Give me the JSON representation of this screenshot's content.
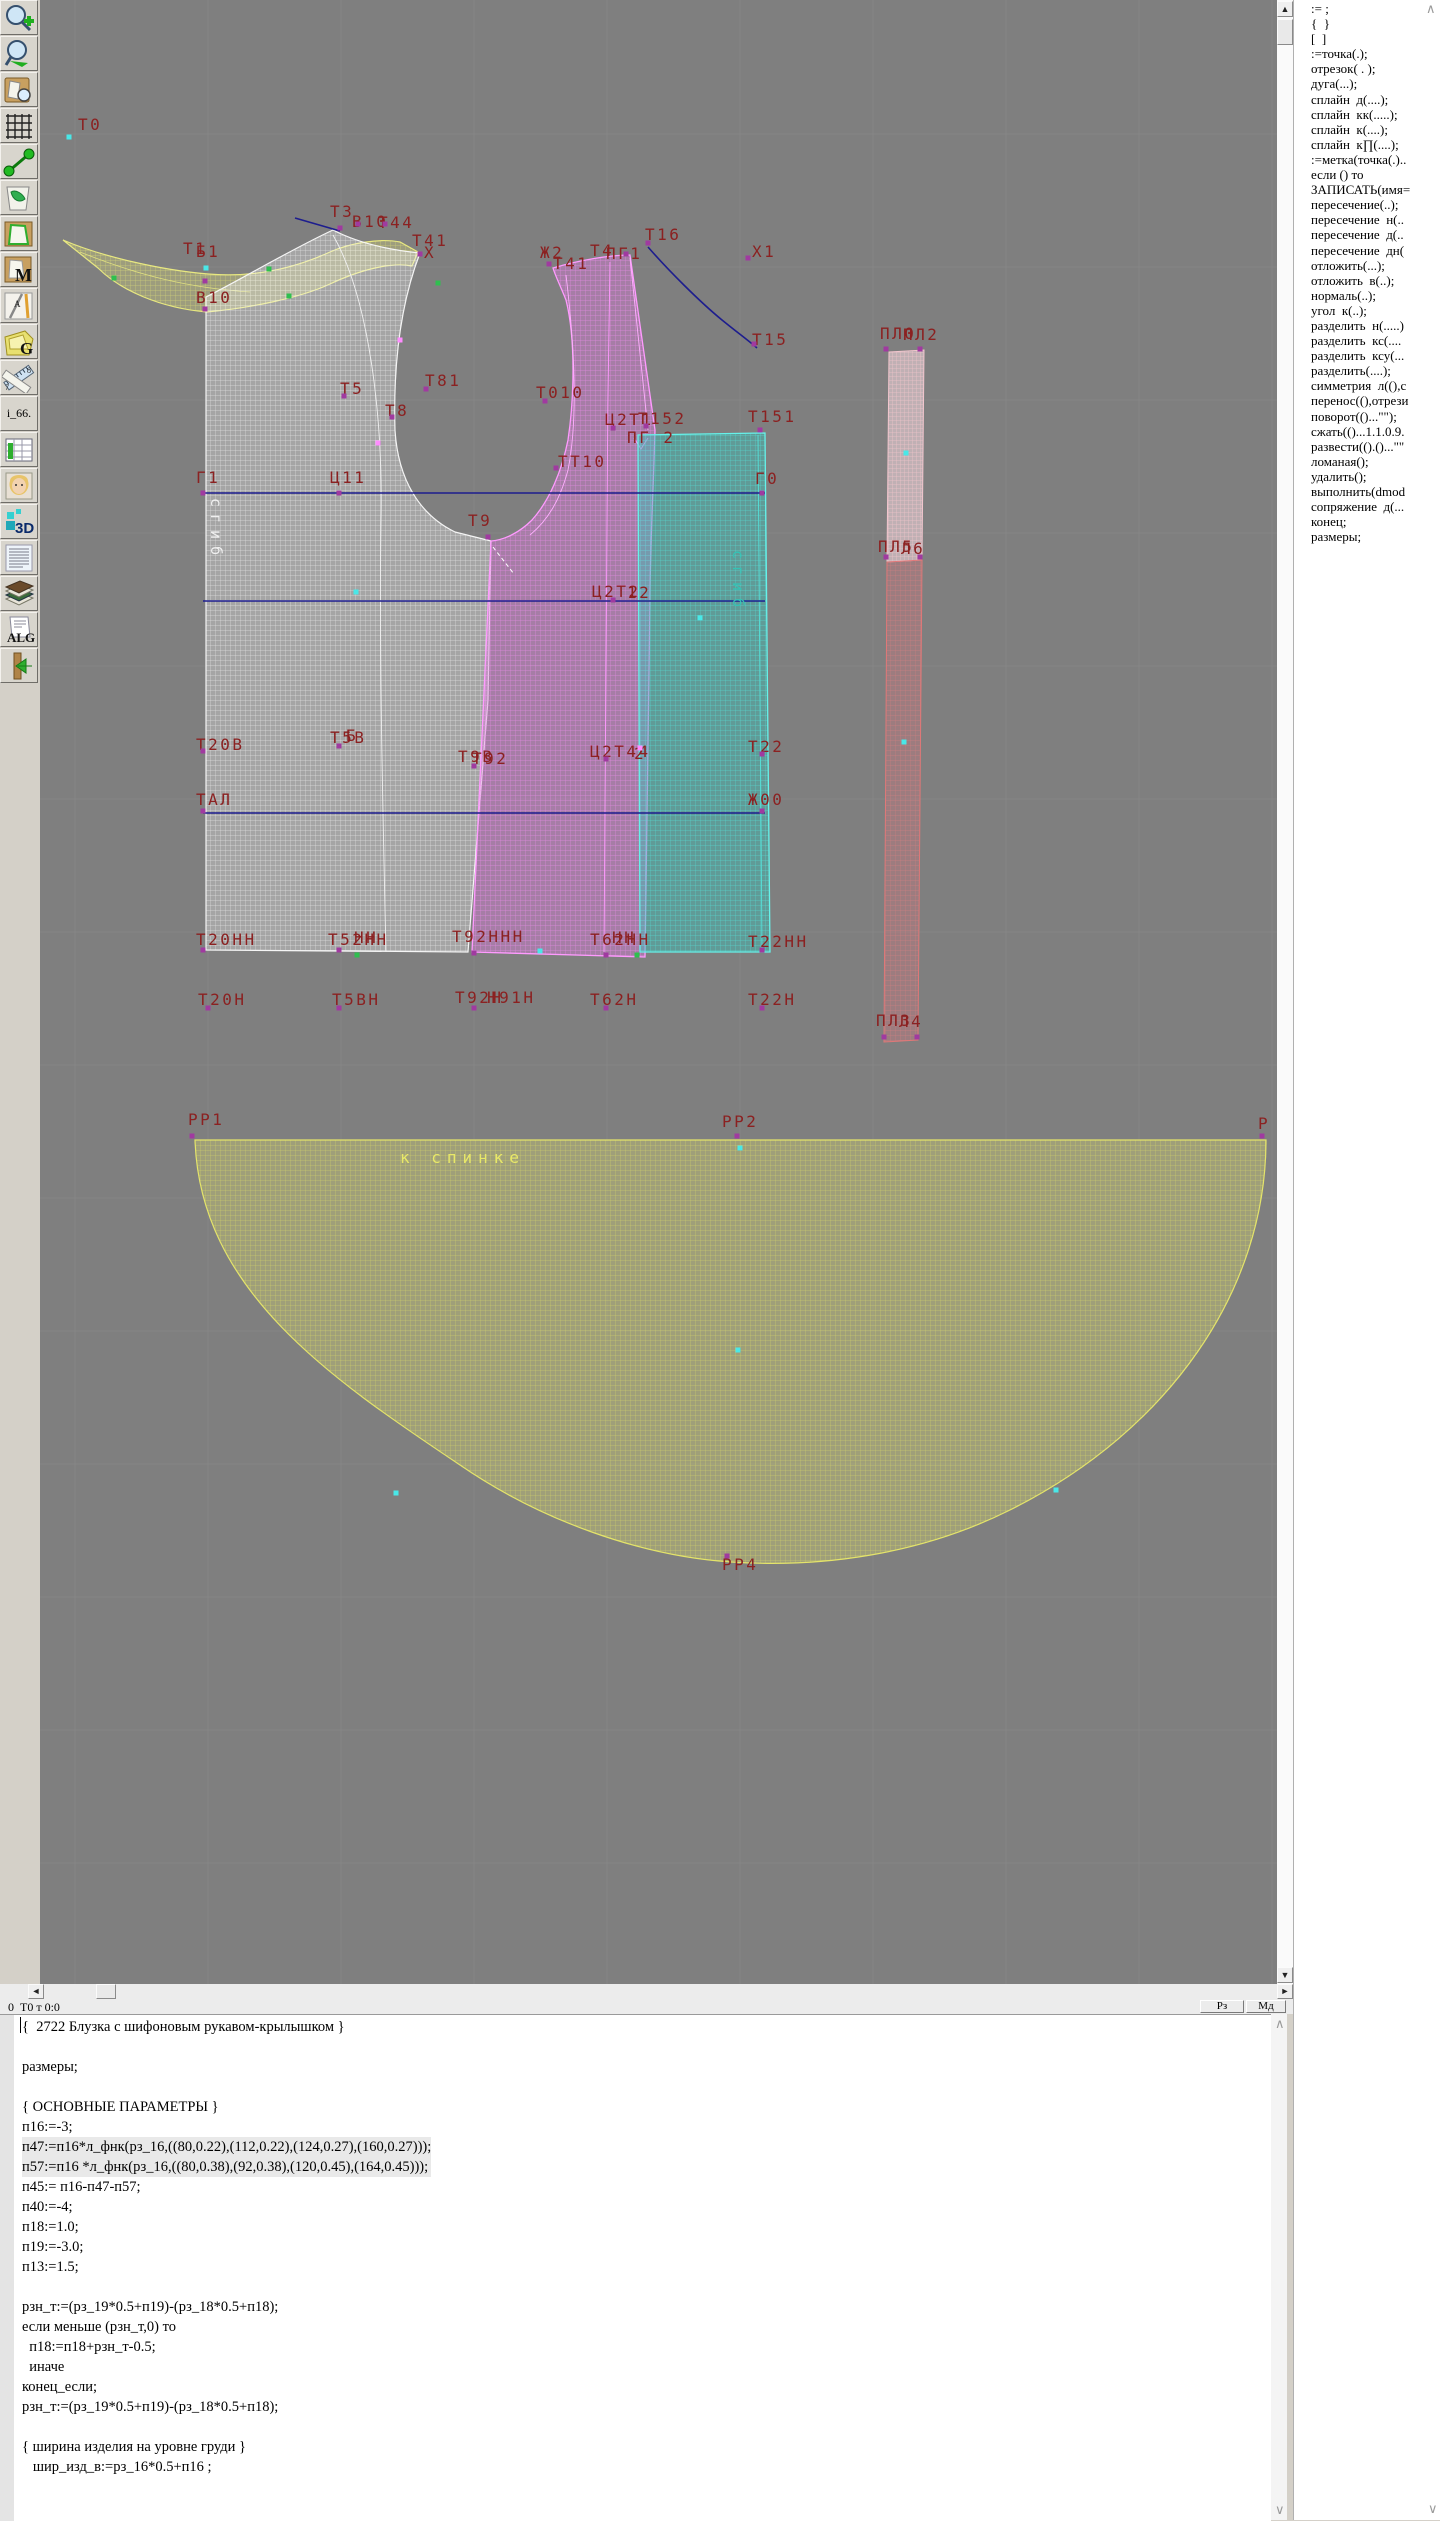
{
  "toolbar": {
    "buttons": [
      {
        "name": "zoom-in-icon"
      },
      {
        "name": "zoom-out-icon"
      },
      {
        "name": "fit-view-icon"
      },
      {
        "name": "grid-icon"
      },
      {
        "name": "measure-curve-icon"
      },
      {
        "name": "sketch-map-icon"
      },
      {
        "name": "piece-outline-icon"
      },
      {
        "name": "piece-m-icon",
        "glyph": "M"
      },
      {
        "name": "drafting-tools-icon",
        "glyph": "А"
      },
      {
        "name": "piece-g-icon",
        "glyph": "G"
      },
      {
        "name": "ruler-icon",
        "nums": [
          "7",
          "8"
        ]
      },
      {
        "name": "i66-button",
        "label": "i_66."
      },
      {
        "name": "size-table-icon"
      },
      {
        "name": "model-photo-icon"
      },
      {
        "name": "view-3d-icon",
        "glyph": "3D"
      },
      {
        "name": "text-list-icon"
      },
      {
        "name": "reference-books-icon"
      },
      {
        "name": "algorithm-icon",
        "glyph": "ALG"
      },
      {
        "name": "exit-icon"
      }
    ]
  },
  "canvas": {
    "labels": [
      {
        "x": 78,
        "y": 118,
        "t": "Т0"
      },
      {
        "x": 330,
        "y": 205,
        "t": "Т3"
      },
      {
        "x": 352,
        "y": 215,
        "t": "В10"
      },
      {
        "x": 378,
        "y": 216,
        "t": "Т44"
      },
      {
        "x": 183,
        "y": 242,
        "t": "Т1"
      },
      {
        "x": 196,
        "y": 245,
        "t": "Б1"
      },
      {
        "x": 412,
        "y": 234,
        "t": "Т41"
      },
      {
        "x": 424,
        "y": 246,
        "t": "Х"
      },
      {
        "x": 196,
        "y": 291,
        "t": "В10"
      },
      {
        "x": 540,
        "y": 246,
        "t": "Ж2"
      },
      {
        "x": 553,
        "y": 257,
        "t": "Т41"
      },
      {
        "x": 590,
        "y": 244,
        "t": "Т4"
      },
      {
        "x": 606,
        "y": 247,
        "t": "ПГ1"
      },
      {
        "x": 645,
        "y": 228,
        "t": "Т16"
      },
      {
        "x": 752,
        "y": 245,
        "t": "Х1"
      },
      {
        "x": 752,
        "y": 333,
        "t": "Т15"
      },
      {
        "x": 880,
        "y": 327,
        "t": "ПЛ0"
      },
      {
        "x": 903,
        "y": 328,
        "t": "ПЛ2"
      },
      {
        "x": 340,
        "y": 382,
        "t": "Т5"
      },
      {
        "x": 425,
        "y": 374,
        "t": "Т81"
      },
      {
        "x": 385,
        "y": 404,
        "t": "Т8"
      },
      {
        "x": 536,
        "y": 386,
        "t": "Т010"
      },
      {
        "x": 605,
        "y": 413,
        "t": "Ц2Т1"
      },
      {
        "x": 638,
        "y": 412,
        "t": "Т152"
      },
      {
        "x": 627,
        "y": 431,
        "t": "ПГ 2"
      },
      {
        "x": 748,
        "y": 410,
        "t": "Т151"
      },
      {
        "x": 196,
        "y": 471,
        "t": "Г1"
      },
      {
        "x": 330,
        "y": 471,
        "t": "Ц11"
      },
      {
        "x": 558,
        "y": 455,
        "t": "ТТ10"
      },
      {
        "x": 755,
        "y": 472,
        "t": "Г0"
      },
      {
        "x": 468,
        "y": 514,
        "t": "Т9"
      },
      {
        "x": 878,
        "y": 540,
        "t": "ПЛ5"
      },
      {
        "x": 901,
        "y": 542,
        "t": "Л6"
      },
      {
        "x": 592,
        "y": 585,
        "t": "Ц2Т2"
      },
      {
        "x": 627,
        "y": 586,
        "t": "12"
      },
      {
        "x": 196,
        "y": 738,
        "t": "Т20В"
      },
      {
        "x": 330,
        "y": 731,
        "t": "Т5В"
      },
      {
        "x": 346,
        "y": 729,
        "t": "Б"
      },
      {
        "x": 458,
        "y": 750,
        "t": "Т9В"
      },
      {
        "x": 472,
        "y": 752,
        "t": "Т92"
      },
      {
        "x": 590,
        "y": 745,
        "t": "Ц2Т44"
      },
      {
        "x": 634,
        "y": 747,
        "t": "2"
      },
      {
        "x": 748,
        "y": 740,
        "t": "Т22"
      },
      {
        "x": 196,
        "y": 793,
        "t": "ТАЛ"
      },
      {
        "x": 748,
        "y": 793,
        "t": "Ж00"
      },
      {
        "x": 196,
        "y": 933,
        "t": "Т20НН"
      },
      {
        "x": 328,
        "y": 933,
        "t": "Т52НН"
      },
      {
        "x": 354,
        "y": 931,
        "t": "НН"
      },
      {
        "x": 452,
        "y": 930,
        "t": "Т92ННН"
      },
      {
        "x": 590,
        "y": 933,
        "t": "Т62НН"
      },
      {
        "x": 612,
        "y": 931,
        "t": "НН"
      },
      {
        "x": 748,
        "y": 935,
        "t": "Т22НН"
      },
      {
        "x": 198,
        "y": 993,
        "t": "Т20Н"
      },
      {
        "x": 332,
        "y": 993,
        "t": "Т5ВН"
      },
      {
        "x": 455,
        "y": 991,
        "t": "Т92Н"
      },
      {
        "x": 487,
        "y": 991,
        "t": "Н91Н"
      },
      {
        "x": 590,
        "y": 993,
        "t": "Т62Н"
      },
      {
        "x": 748,
        "y": 993,
        "t": "Т22Н"
      },
      {
        "x": 876,
        "y": 1014,
        "t": "ПЛ3"
      },
      {
        "x": 899,
        "y": 1015,
        "t": "Л4"
      },
      {
        "x": 188,
        "y": 1113,
        "t": "РР1"
      },
      {
        "x": 722,
        "y": 1115,
        "t": "РР2"
      },
      {
        "x": 1258,
        "y": 1117,
        "t": "Р"
      },
      {
        "x": 722,
        "y": 1558,
        "t": "РР4"
      }
    ],
    "annotations": {
      "to_back_text": "к спинке",
      "fold_text": "сгиб"
    },
    "guide_lines": [
      [
        203,
        493,
        765,
        493
      ],
      [
        203,
        601,
        765,
        601
      ],
      [
        203,
        813,
        765,
        813
      ]
    ],
    "points": {
      "cyan": [
        [
          69,
          137
        ],
        [
          206,
          268
        ],
        [
          906,
          453
        ],
        [
          904,
          742
        ],
        [
          356,
          592
        ],
        [
          540,
          951
        ],
        [
          700,
          618
        ],
        [
          740,
          1148
        ],
        [
          738,
          1350
        ],
        [
          396,
          1493
        ],
        [
          1056,
          1490
        ]
      ],
      "purple": [
        [
          340,
          228
        ],
        [
          358,
          224
        ],
        [
          385,
          224
        ],
        [
          420,
          254
        ],
        [
          205,
          281
        ],
        [
          205,
          309
        ],
        [
          549,
          264
        ],
        [
          626,
          254
        ],
        [
          648,
          243
        ],
        [
          748,
          258
        ],
        [
          754,
          344
        ],
        [
          886,
          349
        ],
        [
          920,
          349
        ],
        [
          344,
          396
        ],
        [
          426,
          389
        ],
        [
          392,
          417
        ],
        [
          545,
          401
        ],
        [
          613,
          428
        ],
        [
          646,
          426
        ],
        [
          760,
          430
        ],
        [
          203,
          493
        ],
        [
          339,
          493
        ],
        [
          556,
          468
        ],
        [
          762,
          493
        ],
        [
          488,
          537
        ],
        [
          886,
          557
        ],
        [
          920,
          557
        ],
        [
          613,
          600
        ],
        [
          203,
          751
        ],
        [
          339,
          746
        ],
        [
          474,
          766
        ],
        [
          606,
          759
        ],
        [
          762,
          754
        ],
        [
          203,
          811
        ],
        [
          762,
          811
        ],
        [
          203,
          950
        ],
        [
          339,
          950
        ],
        [
          474,
          953
        ],
        [
          606,
          955
        ],
        [
          762,
          950
        ],
        [
          208,
          1008
        ],
        [
          339,
          1008
        ],
        [
          474,
          1008
        ],
        [
          606,
          1008
        ],
        [
          762,
          1008
        ],
        [
          884,
          1037
        ],
        [
          917,
          1037
        ],
        [
          192,
          1136
        ],
        [
          737,
          1136
        ],
        [
          1262,
          1136
        ],
        [
          727,
          1556
        ]
      ],
      "green": [
        [
          114,
          278
        ],
        [
          269,
          269
        ],
        [
          289,
          296
        ],
        [
          438,
          283
        ],
        [
          357,
          955
        ],
        [
          637,
          955
        ]
      ],
      "pink": [
        [
          400,
          340
        ],
        [
          378,
          443
        ],
        [
          640,
          748
        ]
      ]
    },
    "colors": {
      "canvas_bg": "#7f7f7f",
      "grid": "#8b8b8b",
      "label": "#8b2121",
      "guide_blue": "#1d1d8e",
      "collar_yellow": "#e6e67a",
      "back_white": "#f0f0f0",
      "front_pink": "#ff9aff",
      "side_cyan": "#5ae8e0",
      "strip_red": "#e07878",
      "skirt_yellow": "#e0e068"
    }
  },
  "statusbar": {
    "position_text": "0  Т0 т 0:0",
    "rz_label": "Рз",
    "md_label": "Мд"
  },
  "editor": {
    "lines": [
      "{  2722 Блузка с шифоновым рукавом-крылышком }",
      "",
      "размеры;",
      "",
      "{ ОСНОВНЫЕ ПАРАМЕТРЫ }",
      "п16:=-3;",
      "п47:=п16*л_фнк(рз_16,((80,0.22),(112,0.22),(124,0.27),(160,0.27)));",
      "п57:=п16 *л_фнк(рз_16,((80,0.38),(92,0.38),(120,0.45),(164,0.45)));",
      "п45:= п16-п47-п57;",
      "п40:=-4;",
      "п18:=1.0;",
      "п19:=-3.0;",
      "п13:=1.5;",
      "",
      "рзн_т:=(рз_19*0.5+п19)-(рз_18*0.5+п18);",
      "если меньше (рзн_т,0) то",
      "  п18:=п18+рзн_т-0.5;",
      "  иначе",
      "конец_если;",
      "рзн_т:=(рз_19*0.5+п19)-(рз_18*0.5+п18);",
      "",
      "{ ширина изделия на уровне груди }",
      "   шир_изд_в:=рз_16*0.5+п16 ;"
    ],
    "highlighted_lines": [
      6,
      7
    ]
  },
  "command_list": {
    "items": [
      ":= ;",
      "{  }",
      "[  ]",
      ":=точка(.);",
      "отрезок( . );",
      "дуга(...);",
      "сплайн  д(....);",
      "сплайн  кк(.....);",
      "сплайн  к(....);",
      "сплайн  к∏(....);",
      ":=метка(точка(.)..",
      "если () то",
      "ЗАПИСАТЬ(имя=",
      "пересечение(..);",
      "пересечение  н(..",
      "пересечение  д(..",
      "пересечение  дн(",
      "отложить(...);",
      "отложить  в(..);",
      "нормаль(..);",
      "угол  к(..);",
      "разделить  н(.....)",
      "разделить  кс(....",
      "разделить  ксу(...",
      "разделить(....);",
      "симметрия  л((),с",
      "перенос((),отрези",
      "поворот(()...\"\");",
      "сжать(()...1.1.0.9.",
      "развести(().()...\"\"",
      "ломаная();",
      "удалить();",
      "выполнить(dmod",
      "сопряжение  д(...",
      "конец;",
      "размеры;"
    ]
  }
}
